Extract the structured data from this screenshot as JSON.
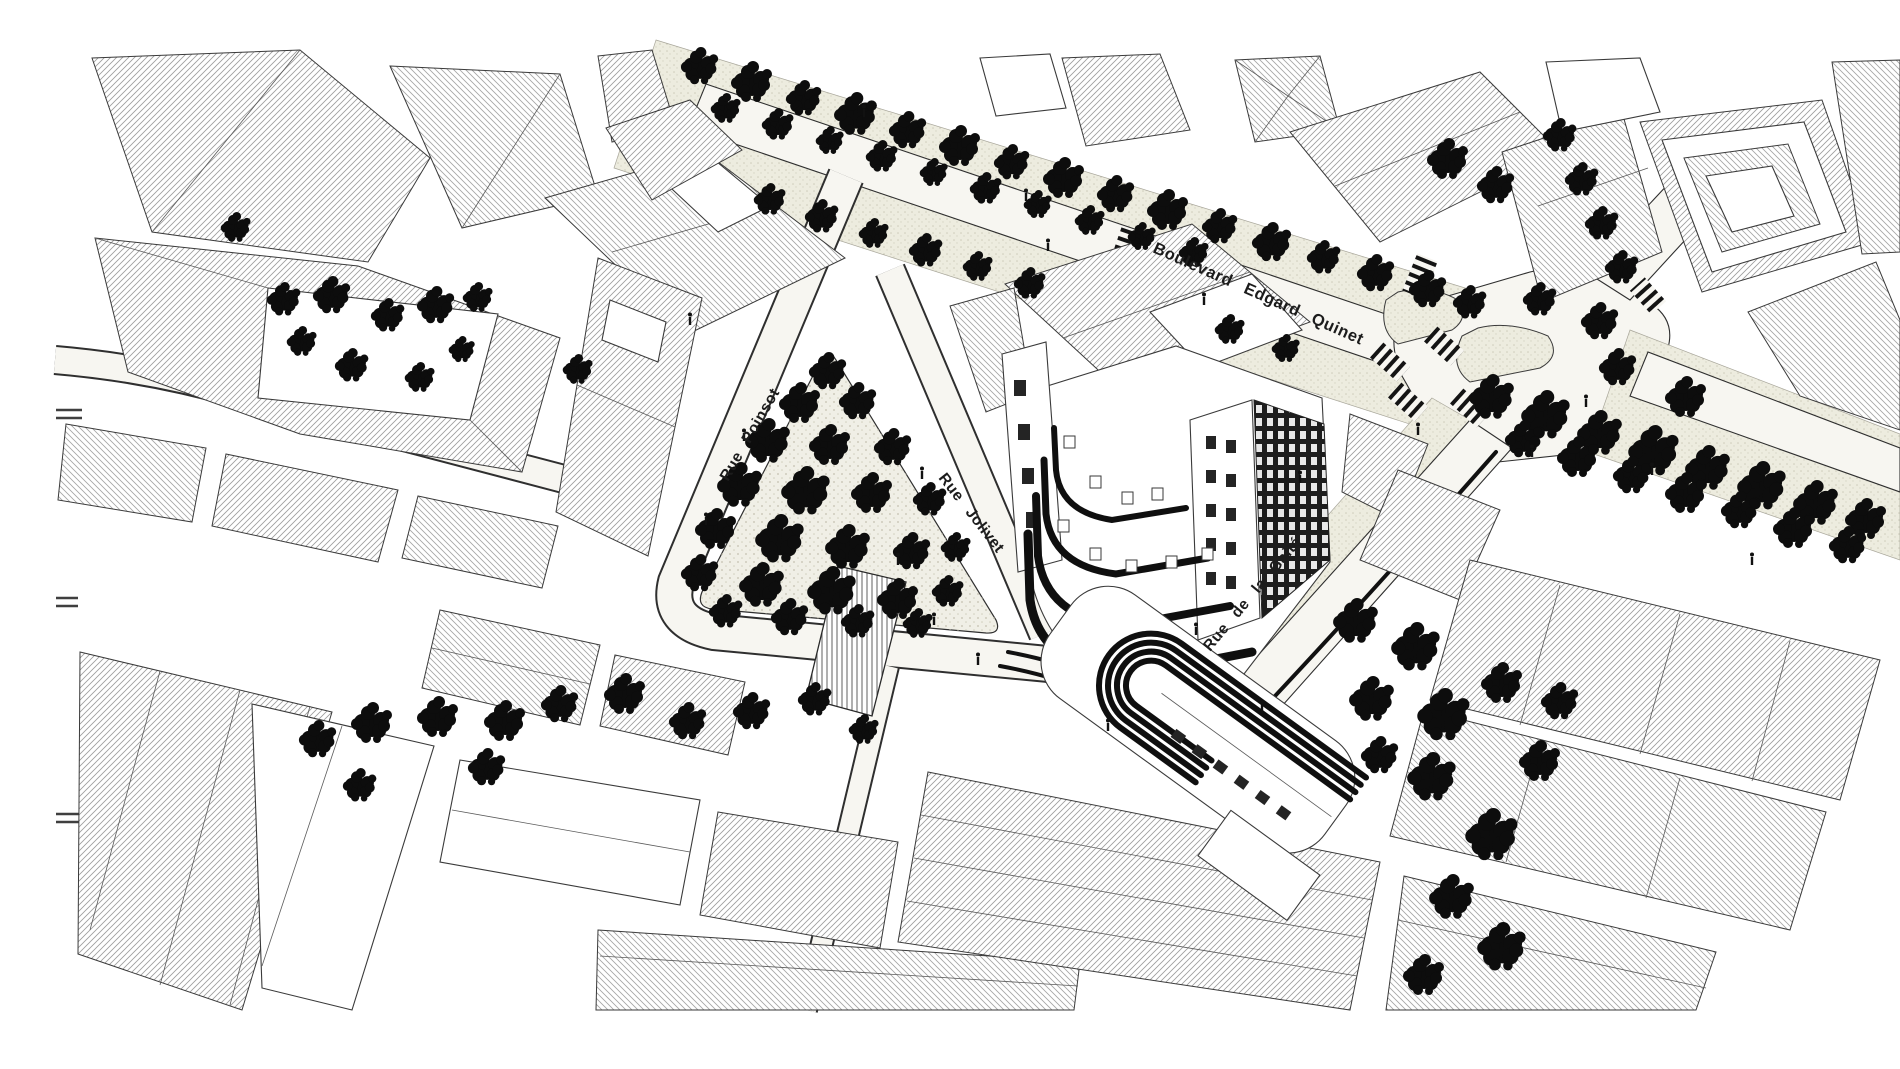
{
  "title": "Plan axonométrique — quartier Gaîté Montparnasse",
  "canvas": {
    "width": 1900,
    "height": 1069
  },
  "palette": {
    "paper": "#ffffff",
    "ink": "#1c1c1c",
    "outline": "#3a3a3a",
    "hatch": "#9c9c9c",
    "hatch_dense": "#7f7f7f",
    "road": "#f7f6f1",
    "sidewalk": "#edecdf",
    "park": "#f0efe6",
    "tree": "#0d0d0d"
  },
  "labels": {
    "boulevard": {
      "text": "Boulevard Edgard Quinet"
    },
    "poinsot": {
      "text": "Rue Poinsot"
    },
    "jolivet": {
      "text": "Rue Jolivet"
    },
    "gaite": {
      "text": "Rue de la Gaité"
    }
  },
  "trees": {
    "park_square": [
      [
        828,
        372,
        20
      ],
      [
        800,
        404,
        22
      ],
      [
        858,
        402,
        20
      ],
      [
        768,
        442,
        24
      ],
      [
        830,
        446,
        22
      ],
      [
        893,
        448,
        20
      ],
      [
        740,
        486,
        24
      ],
      [
        806,
        492,
        26
      ],
      [
        872,
        494,
        22
      ],
      [
        930,
        500,
        18
      ],
      [
        716,
        530,
        22
      ],
      [
        780,
        540,
        26
      ],
      [
        848,
        548,
        24
      ],
      [
        912,
        552,
        20
      ],
      [
        956,
        548,
        16
      ],
      [
        700,
        574,
        20
      ],
      [
        762,
        586,
        24
      ],
      [
        832,
        592,
        26
      ],
      [
        898,
        600,
        22
      ],
      [
        948,
        592,
        17
      ],
      [
        726,
        612,
        18
      ],
      [
        790,
        618,
        20
      ],
      [
        858,
        622,
        18
      ],
      [
        918,
        624,
        16
      ]
    ],
    "boulevard_north_row": [
      [
        700,
        67,
        20
      ],
      [
        752,
        83,
        22
      ],
      [
        804,
        99,
        19
      ],
      [
        856,
        115,
        23
      ],
      [
        908,
        131,
        20
      ],
      [
        960,
        147,
        22
      ],
      [
        1012,
        163,
        19
      ],
      [
        1064,
        179,
        22
      ],
      [
        1116,
        195,
        20
      ],
      [
        1168,
        211,
        22
      ],
      [
        1220,
        227,
        19
      ],
      [
        1272,
        243,
        21
      ],
      [
        1324,
        258,
        18
      ],
      [
        1376,
        274,
        20
      ],
      [
        1428,
        290,
        20
      ],
      [
        1470,
        303,
        18
      ]
    ],
    "boulevard_inner_row": [
      [
        726,
        109,
        16
      ],
      [
        778,
        125,
        17
      ],
      [
        830,
        141,
        15
      ],
      [
        882,
        157,
        17
      ],
      [
        934,
        173,
        15
      ],
      [
        986,
        189,
        17
      ],
      [
        1038,
        205,
        15
      ],
      [
        1090,
        221,
        16
      ],
      [
        1142,
        237,
        15
      ],
      [
        1194,
        253,
        16
      ]
    ],
    "boulevard_south_row": [
      [
        770,
        200,
        17
      ],
      [
        822,
        217,
        18
      ],
      [
        874,
        234,
        16
      ],
      [
        926,
        251,
        18
      ],
      [
        978,
        267,
        16
      ],
      [
        1030,
        284,
        17
      ],
      [
        1230,
        330,
        16
      ],
      [
        1286,
        349,
        15
      ]
    ],
    "northeast_row": [
      [
        1560,
        136,
        18
      ],
      [
        1582,
        180,
        18
      ],
      [
        1602,
        224,
        18
      ],
      [
        1622,
        268,
        18
      ],
      [
        1448,
        160,
        22
      ],
      [
        1496,
        186,
        20
      ]
    ],
    "east_plaza": [
      [
        1540,
        300,
        18
      ],
      [
        1600,
        322,
        20
      ],
      [
        1618,
        368,
        20
      ],
      [
        1686,
        398,
        22
      ]
    ],
    "east_avenue_row": [
      [
        1492,
        398,
        24
      ],
      [
        1546,
        416,
        26
      ],
      [
        1600,
        434,
        24
      ],
      [
        1654,
        452,
        27
      ],
      [
        1708,
        469,
        24
      ],
      [
        1762,
        487,
        26
      ],
      [
        1816,
        504,
        24
      ],
      [
        1866,
        520,
        22
      ],
      [
        1524,
        440,
        20
      ],
      [
        1578,
        458,
        22
      ],
      [
        1632,
        476,
        20
      ],
      [
        1686,
        494,
        22
      ],
      [
        1740,
        511,
        20
      ],
      [
        1794,
        529,
        22
      ],
      [
        1848,
        546,
        20
      ]
    ],
    "southeast_cluster": [
      [
        1356,
        622,
        24
      ],
      [
        1416,
        648,
        26
      ],
      [
        1372,
        700,
        24
      ],
      [
        1444,
        716,
        28
      ],
      [
        1502,
        684,
        22
      ],
      [
        1432,
        778,
        26
      ],
      [
        1492,
        836,
        28
      ],
      [
        1452,
        898,
        24
      ],
      [
        1502,
        948,
        26
      ],
      [
        1424,
        976,
        22
      ],
      [
        1540,
        762,
        22
      ],
      [
        1560,
        702,
        20
      ],
      [
        1380,
        756,
        20
      ]
    ],
    "west_courtyard": [
      [
        284,
        300,
        18
      ],
      [
        332,
        296,
        20
      ],
      [
        388,
        316,
        18
      ],
      [
        436,
        306,
        20
      ],
      [
        478,
        298,
        16
      ],
      [
        302,
        342,
        16
      ],
      [
        352,
        366,
        18
      ],
      [
        420,
        378,
        16
      ],
      [
        462,
        350,
        14
      ],
      [
        236,
        228,
        16
      ],
      [
        578,
        370,
        16
      ]
    ],
    "southwest_cluster": [
      [
        318,
        740,
        20
      ],
      [
        372,
        724,
        22
      ],
      [
        438,
        718,
        22
      ],
      [
        505,
        722,
        22
      ],
      [
        487,
        768,
        20
      ],
      [
        360,
        786,
        18
      ]
    ],
    "south_center_row": [
      [
        560,
        705,
        20
      ],
      [
        625,
        695,
        22
      ],
      [
        688,
        722,
        20
      ],
      [
        752,
        712,
        20
      ],
      [
        815,
        700,
        18
      ],
      [
        864,
        730,
        16
      ]
    ]
  },
  "people": [
    [
      744,
      436
    ],
    [
      706,
      520
    ],
    [
      898,
      560
    ],
    [
      934,
      620
    ],
    [
      1048,
      246
    ],
    [
      1204,
      300
    ],
    [
      1300,
      478
    ],
    [
      1418,
      430
    ],
    [
      1532,
      452
    ],
    [
      978,
      660
    ],
    [
      1196,
      630
    ],
    [
      864,
      112
    ],
    [
      1026,
      196
    ],
    [
      1652,
      470
    ],
    [
      1752,
      560
    ],
    [
      1262,
      708
    ],
    [
      1108,
      726
    ],
    [
      922,
      474
    ],
    [
      690,
      320
    ],
    [
      1586,
      402
    ]
  ]
}
